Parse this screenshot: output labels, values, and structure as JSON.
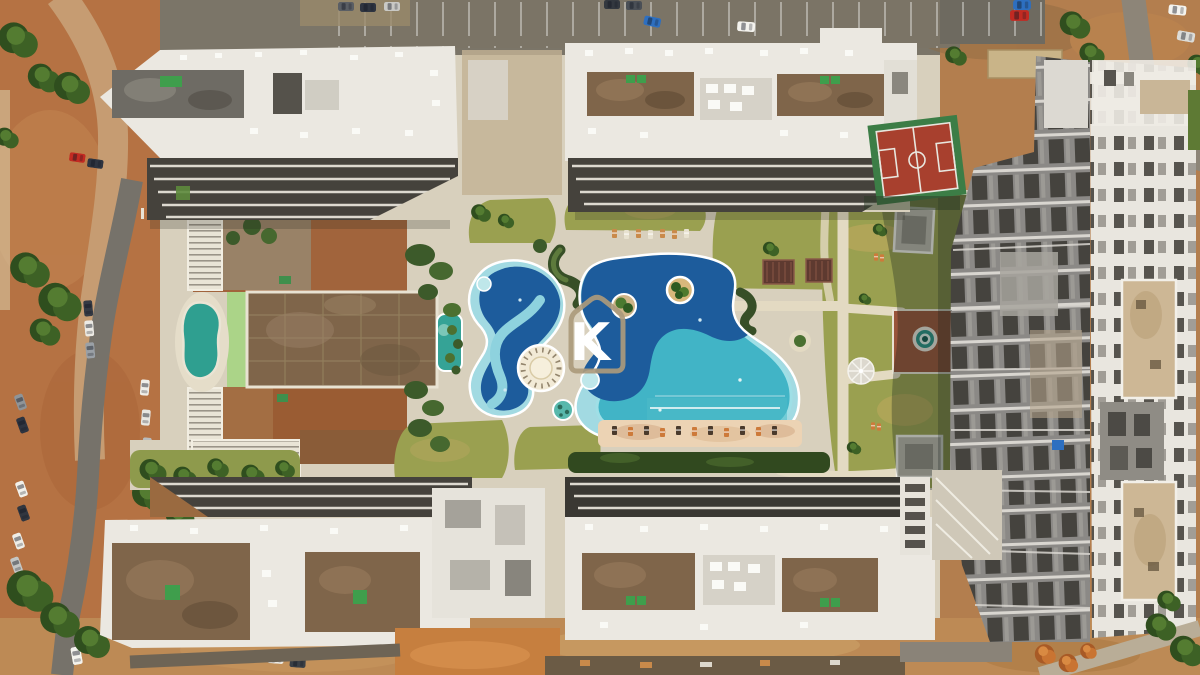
{
  "image": {
    "kind": "aerial-drone-photograph",
    "subject": "Top-down aerial view of a residential condominium complex with free-form swimming pools, landscaped courtyard, sport court, parking streets and apartment buildings under construction",
    "width_px": 1200,
    "height_px": 675
  },
  "watermark": {
    "letter": "K",
    "shape": "house-outline",
    "outline_color": "#ab9a7c",
    "letter_color": "#ffffff"
  },
  "palette": {
    "pavement": "#d8d0bd",
    "pool_dark_blue": "#1d5c9c",
    "pool_turquoise": "#41b4c6",
    "pool_pale_blue": "#a2dae2",
    "lawn_green": "#9aa050",
    "dirt_orange": "#b57243",
    "building_white": "#ebe8e1",
    "construction_gray": "#8b8986",
    "hedge_dark_green": "#37502a",
    "teal_pond": "#2f9f90",
    "sport_court_red": "#a8402e",
    "sport_court_green": "#3c7d46",
    "roof_brown": "#7f654a",
    "asphalt": "#76726a",
    "sand_deck": "#ecd3b4"
  },
  "features": [
    {
      "id": "pool-left",
      "label": "Free-form leisure pool with light-blue channel"
    },
    {
      "id": "pool-right",
      "label": "Large free-form pool with palm island and lap lanes"
    },
    {
      "id": "spiral-deck",
      "label": "Round timber deck with spiral steps"
    },
    {
      "id": "palm-island",
      "label": "Palm tree island"
    },
    {
      "id": "basketball-court",
      "label": "Red and green sport court"
    },
    {
      "id": "brown-courtyard-slab",
      "label": "Unfinished courtyard slab"
    },
    {
      "id": "teal-pond",
      "label": "Teal landscape pond"
    },
    {
      "id": "right-lawn",
      "label": "Lawn with winding paths, dome and spa circle"
    },
    {
      "id": "construction-building",
      "label": "High-rise block under construction"
    },
    {
      "id": "parking-street",
      "label": "Street with parked cars"
    }
  ]
}
